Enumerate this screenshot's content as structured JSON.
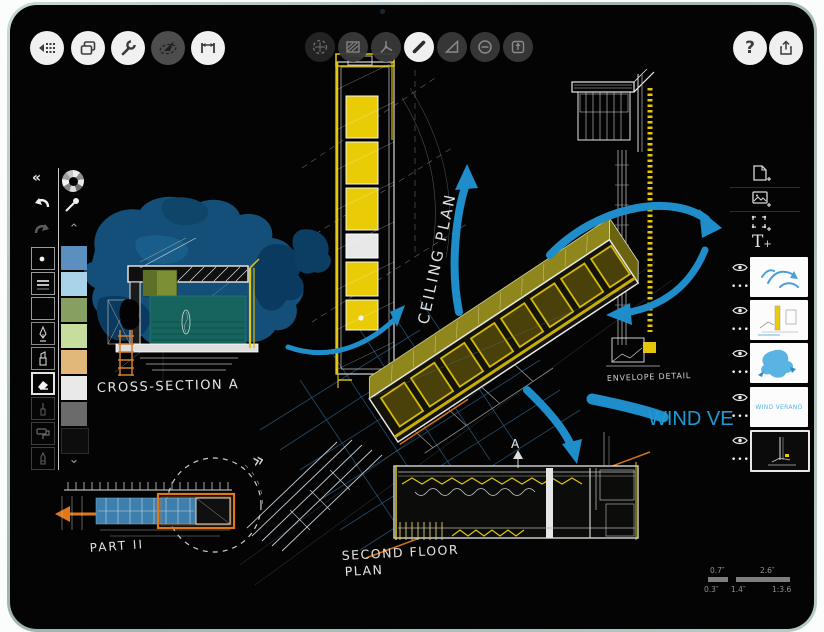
{
  "toolbar_left": {
    "buttons": [
      {
        "name": "gallery-grid",
        "icon": "grid-back-icon"
      },
      {
        "name": "duplicate",
        "icon": "duplicate-icon"
      },
      {
        "name": "settings",
        "icon": "wrench-icon"
      },
      {
        "name": "compass",
        "icon": "compass-icon"
      },
      {
        "name": "measure",
        "icon": "measure-icon"
      }
    ]
  },
  "toolbar_center": {
    "buttons": [
      {
        "name": "transform",
        "icon": "transform-icon"
      },
      {
        "name": "fill",
        "icon": "hatch-fill-icon"
      },
      {
        "name": "guides",
        "icon": "axis-icon"
      },
      {
        "name": "pen",
        "icon": "line-pen-icon",
        "selected": true
      },
      {
        "name": "shape",
        "icon": "triangle-icon"
      },
      {
        "name": "erase",
        "icon": "minus-circle-icon"
      },
      {
        "name": "export",
        "icon": "export-arrow-icon"
      }
    ]
  },
  "toolbar_right": {
    "help_label": "?",
    "share_icon": "share-icon"
  },
  "tool_panel": {
    "collapse_label": "«",
    "chevron_up": "⌃",
    "chevron_down": "⌄",
    "tools": [
      "dot-brush",
      "ruled-lines",
      "empty-slot",
      "fountain-pen",
      "chisel-marker",
      "eraser",
      "fineliner",
      "paint-roller",
      "brush-marker"
    ],
    "swatches": [
      "#5b8fc0",
      "#a9d3e8",
      "#87a061",
      "#c6dd9e",
      "#e2b77a",
      "#e9e9e9",
      "#6b6b6b",
      "#0d0d0d"
    ]
  },
  "layers_panel": {
    "actions": [
      "add-page",
      "add-image",
      "add-selection",
      "add-text"
    ],
    "text_tool_label": "T",
    "layers": [
      {
        "name": "blue-arrows-layer"
      },
      {
        "name": "detail-sketch-layer"
      },
      {
        "name": "blue-wash-layer"
      },
      {
        "name": "wind-verano-layer",
        "text": "WIND VERANO"
      },
      {
        "name": "dark-sketch-layer",
        "selected": true
      }
    ]
  },
  "canvas": {
    "labels": {
      "ceiling_plan": "CEILING PLAN",
      "cross_section": "CROSS-SECTION A",
      "envelope_detail": "ENVELOPE DETAIL",
      "wind_ve": "WIND VE",
      "second_floor_1": "SECOND FLOOR",
      "second_floor_2": "PLAN",
      "part2": "PART II",
      "marker_a": "A",
      "chevrons": "»"
    },
    "scale": {
      "top_small": "0.7″",
      "top_large": "2.6″",
      "bottom_left": "0.3″",
      "bottom_mid": "1.4″",
      "ratio": "1:3.6"
    },
    "colors": {
      "arrow_blue": "#1f8dca",
      "accent_yellow": "#e6c60a",
      "wash_blue": "#14527e",
      "wash_dark": "#0b3a60",
      "teal_fill": "#17635d",
      "olive": "#8f861c",
      "orange": "#d9821f",
      "label_blue": "#1f9ad4"
    }
  }
}
